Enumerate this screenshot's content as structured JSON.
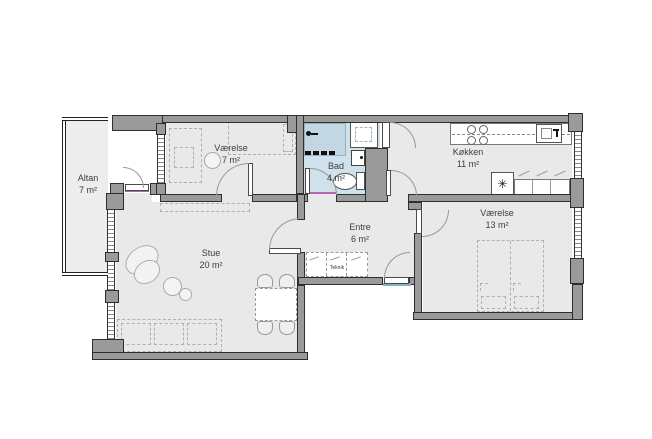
{
  "rooms": {
    "altan": {
      "name": "Altan",
      "area": "7 m²"
    },
    "vaerelse_small": {
      "name": "Værelse",
      "area": "7 m²"
    },
    "bad": {
      "name": "Bad",
      "area": "4 m²"
    },
    "koekken": {
      "name": "Køkken",
      "area": "11 m²"
    },
    "entre": {
      "name": "Entre",
      "area": "6 m²"
    },
    "stue": {
      "name": "Stue",
      "area": "20 m²"
    },
    "vaerelse_large": {
      "name": "Værelse",
      "area": "13 m²"
    }
  },
  "labels": {
    "teknik": "Teknik"
  },
  "symbols": {
    "refrigerator": "✳"
  },
  "colors": {
    "wall": "#9a9a9a",
    "wall_outline": "#2e2e2e",
    "room_floor": "#e9e9e9",
    "bath_floor": "#cfe1ea",
    "shower_floor": "#c2d7e1",
    "front_door_threshold": "#7fb3c6",
    "door_accent": "#b066b0",
    "label_text": "#3c3c44"
  }
}
